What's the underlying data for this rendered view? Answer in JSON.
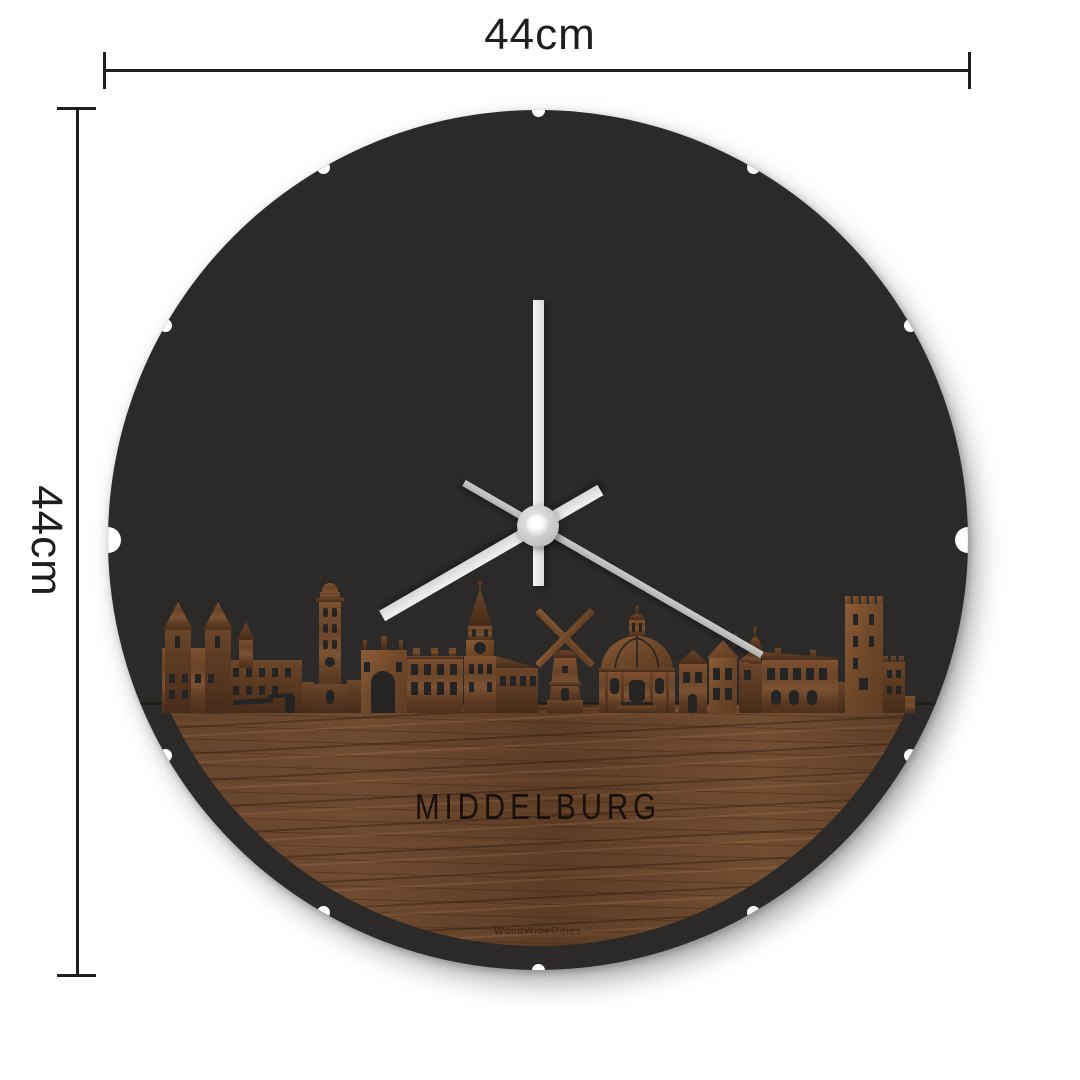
{
  "dimension_labels": {
    "width": "44cm",
    "height": "44cm"
  },
  "clock": {
    "city_label": "MIDDELBURG",
    "watermark": "WoodWideCities",
    "time_hands": {
      "minute_angle_deg": 0,
      "hour_angle_deg": 240,
      "second_angle_deg": 120
    },
    "rim_notches": {
      "angles_deg": [
        0,
        30,
        60,
        90,
        120,
        150,
        180,
        210,
        240,
        270,
        300,
        330
      ],
      "large_angles_deg": [
        90,
        270
      ],
      "small_diameter_px": 13,
      "large_diameter_px": 26
    }
  },
  "colors": {
    "background": "#ffffff",
    "face": "#2b2a28",
    "dimension_lines": "#1e1e1e",
    "hand_primary": "#e9e9e9",
    "hand_second": "#bdbdbd",
    "wood_base": "#5e3d27",
    "engraved_text": "#17100b"
  }
}
